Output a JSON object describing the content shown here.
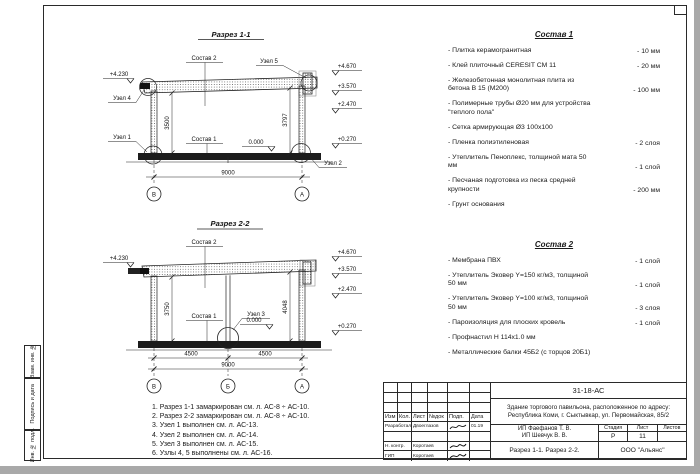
{
  "frame": {
    "side_labels": [
      "Взам. инв. №",
      "Подпись и дата",
      "Инв. № подл."
    ]
  },
  "s1": {
    "title": "Разрез 1-1",
    "lbl_sostav2": "Состав 2",
    "lbl_sostav1": "Состав 1",
    "lbl_uzel1": "Узел 1",
    "lbl_uzel2": "Узел 2",
    "lbl_uzel4": "Узел 4",
    "lbl_uzel5": "Узел 5",
    "zero_mark": "0.000",
    "elev_left": "+4.230",
    "elev_right": [
      "+4.670",
      "+3.570",
      "+2.470",
      "+0.270"
    ],
    "dim_h_left": "3500",
    "dim_h_right": "3797",
    "dim_w": "9000",
    "axis_left": "В",
    "axis_right": "А"
  },
  "s2": {
    "title": "Разрез 2-2",
    "lbl_sostav2": "Состав 2",
    "lbl_sostav1": "Состав 1",
    "lbl_uzel3": "Узел 3",
    "zero_mark": "0.000",
    "elev_left": "+4.230",
    "elev_right": [
      "+4.670",
      "+3.570",
      "+2.470",
      "+0.270"
    ],
    "dim_h_left": "3750",
    "dim_h_right": "4048",
    "dim_w1": "4500",
    "dim_w2": "4500",
    "dim_w": "9000",
    "axis_left": "В",
    "axis_mid": "Б",
    "axis_right": "А"
  },
  "sostav1": {
    "title": "Состав 1",
    "items": [
      {
        "name": "- Плитка керамогранитная",
        "value": "- 10 мм"
      },
      {
        "name": "- Клей плиточный CERESIT СМ 11",
        "value": "- 20 мм"
      },
      {
        "name": "- Железобетонная  монолитная плита из бетона В 15 (М200)",
        "value": "- 100 мм"
      },
      {
        "name": "- Полимерные трубы Ø20 мм для устройства \"теплого пола\"",
        "value": ""
      },
      {
        "name": "- Сетка армирующая Ø3 100х100",
        "value": ""
      },
      {
        "name": "- Пленка полиэтиленовая",
        "value": "- 2 слоя"
      },
      {
        "name": "- Утеплитель Пеноплекс, толщиной мата 50 мм",
        "value": "- 1 слой"
      },
      {
        "name": "- Песчаная подготовка из песка средней крупности",
        "value": "- 200 мм"
      },
      {
        "name": "- Грунт основания",
        "value": ""
      }
    ]
  },
  "sostav2": {
    "title": "Состав 2",
    "items": [
      {
        "name": "- Мембрана ПВХ",
        "value": "- 1 слой"
      },
      {
        "name": "- Утеплитель Эковер Y=150 кг/м3, толщиной 50 мм",
        "value": "- 1 слой"
      },
      {
        "name": "- Утеплитель Эковер Y=100 кг/м3, толщиной 50 мм",
        "value": "- 3 слоя"
      },
      {
        "name": "- Пароизоляция для плоских кровель",
        "value": "- 1 слой"
      },
      {
        "name": "- Профнастил Н 114х1.0 мм",
        "value": ""
      },
      {
        "name": "- Металлические балки 45Б2 (с торцов 20Б1)",
        "value": ""
      }
    ]
  },
  "notes": [
    "1. Разрез 1-1 замаркирован см. л. АС-8 ÷ АС-10.",
    "2. Разрез 2-2 замаркирован см. л. АС-8 ÷ АС-10.",
    "3. Узел 1 выполнен см. л. АС-13.",
    "4. Узел 2 выполнен см. л. АС-14.",
    "5. Узел 3 выполнен см. л. АС-15.",
    "6. Узлы 4, 5 выполнены см. л. АС-16."
  ],
  "titleblock": {
    "doc_number": "31-18-АС",
    "object": "Здание торгового павильона, расположенное по адресу: Республика Коми, г. Сыктывкар, ул. Первомайская, 85/2",
    "cols": [
      "Изм",
      "Кол.",
      "Лист",
      "№док",
      "Подп.",
      "Дата"
    ],
    "row1_role": "Разработал",
    "row1_name": "Двоеглазов",
    "row1_date": "01.19",
    "row3_role": "Н. контр.",
    "row3_name": "Коротаев",
    "row4_role": "ГИП",
    "row4_name": "Коротаев",
    "client1": "ИП Фаефанов Т. В.",
    "client2": "ИП Шевчук В. В.",
    "stage_label": "Стадия",
    "sheet_label": "Лист",
    "sheets_label": "Листов",
    "stage": "Р",
    "sheet": "11",
    "sheets": "",
    "sheet_title": "Разрез 1-1. Разрез 2-2.",
    "company": "ООО \"Альянс\""
  }
}
